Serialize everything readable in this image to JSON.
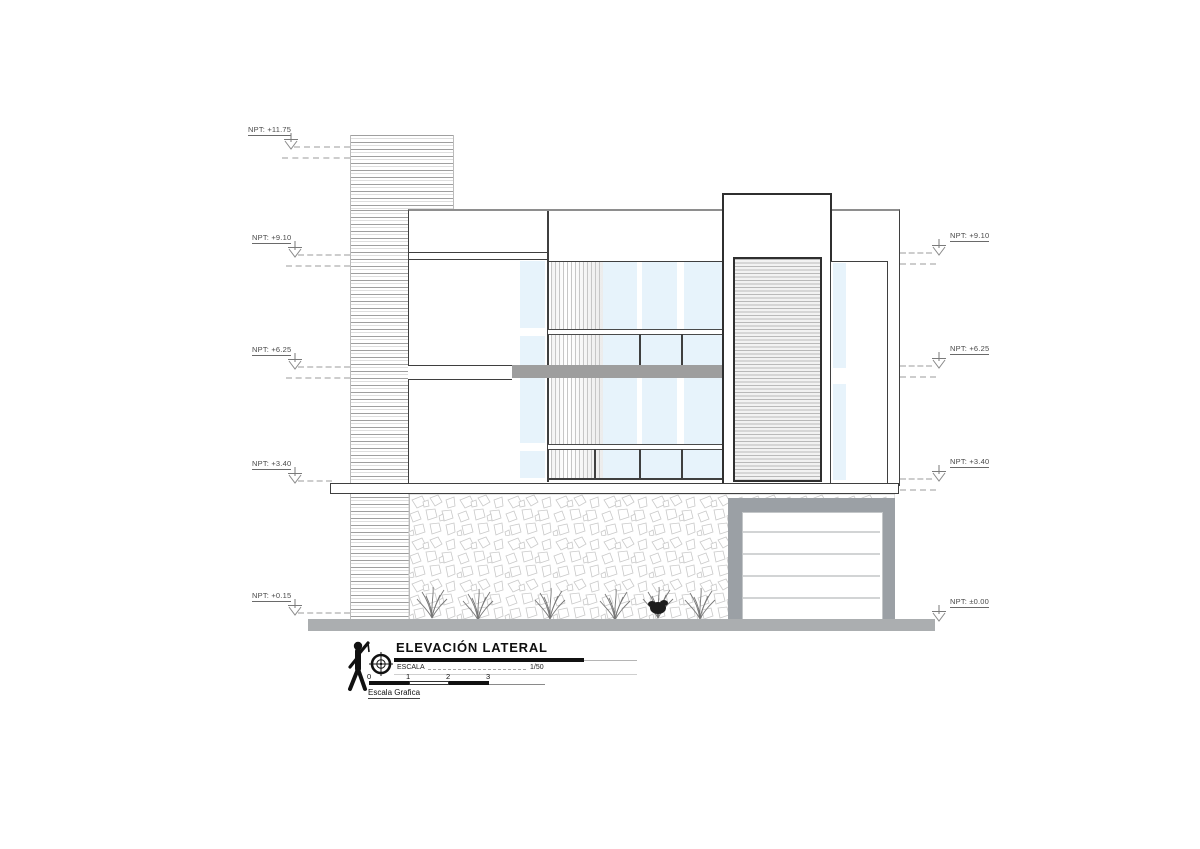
{
  "drawing": {
    "title": "ELEVACIÓN LATERAL",
    "scale_label": "ESCALA",
    "scale_value": "1/50",
    "graphic_scale": {
      "ticks": [
        "0",
        "1",
        "2",
        "3"
      ],
      "caption": "Escala Grafica"
    }
  },
  "levels": {
    "left": [
      {
        "label": "NPT: +11.75"
      },
      {
        "label": "NPT: +9.10"
      },
      {
        "label": "NPT: +6.25"
      },
      {
        "label": "NPT: +3.40"
      },
      {
        "label": "NPT: +0.15"
      }
    ],
    "right": [
      {
        "label": "NPT: +9.10"
      },
      {
        "label": "NPT: +6.25"
      },
      {
        "label": "NPT: +3.40"
      },
      {
        "label": "NPT: ±0.00"
      }
    ]
  },
  "colors": {
    "line": "#3f3f3f",
    "glass": "#e7f3fb",
    "slab_gray": "#9e9e9e",
    "garage_frame": "#9ba0a5",
    "ground": "#abaeb0",
    "dash": "#cdcdcd"
  }
}
